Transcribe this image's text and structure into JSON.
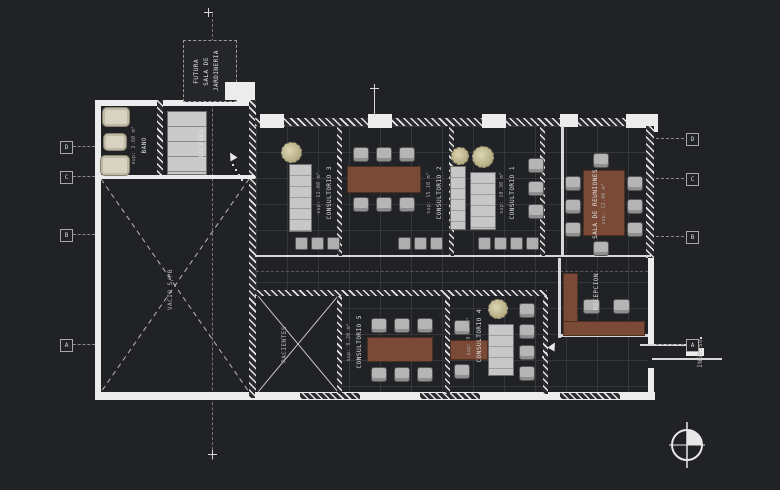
{
  "colors": {
    "background": "#202226",
    "wall": "#ececec",
    "desk_wood": "#7a4a36",
    "chair_gray": "#b5b5b5",
    "fixture_beige": "#d8d2c0",
    "grid_line": "#35373b"
  },
  "rooms": {
    "futura": {
      "line1": "FUTURA",
      "line2": "SALA DE",
      "line3": "JARDINERIA"
    },
    "bano": {
      "name": "BAÑO",
      "sup": "sup: 2.60 m²"
    },
    "lockers": {
      "name": "LOCKERS"
    },
    "vacio": {
      "name": "VACIO S/PB"
    },
    "consultorio3": {
      "name": "CONSULTORIO 3",
      "sup": "sup: 11.60 m²"
    },
    "consultorio2": {
      "name": "CONSULTORIO 2",
      "sup": "sup: 15.10 m²"
    },
    "consultorio1": {
      "name": "CONSULTORIO 1",
      "sup": "sup: 10.30 m²"
    },
    "sala_reuniones": {
      "name": "SALA DE REUNIONES",
      "sup": "sup: 12.40 m²"
    },
    "recepcion": {
      "name": "RECEPCION"
    },
    "pacientes": {
      "name": "PACIENTES"
    },
    "consultorio5": {
      "name": "CONSULTORIO 5",
      "sup": "sup: 9.20 m²"
    },
    "consultorio4": {
      "name": "CONSULTORIO 4",
      "sup": "sup: 9.45 m²"
    },
    "ingreso": {
      "name": "INGRESO"
    }
  },
  "grid_markers": {
    "left": [
      "D",
      "C",
      "B",
      "A"
    ],
    "right": [
      "D",
      "C",
      "B",
      "A"
    ]
  }
}
